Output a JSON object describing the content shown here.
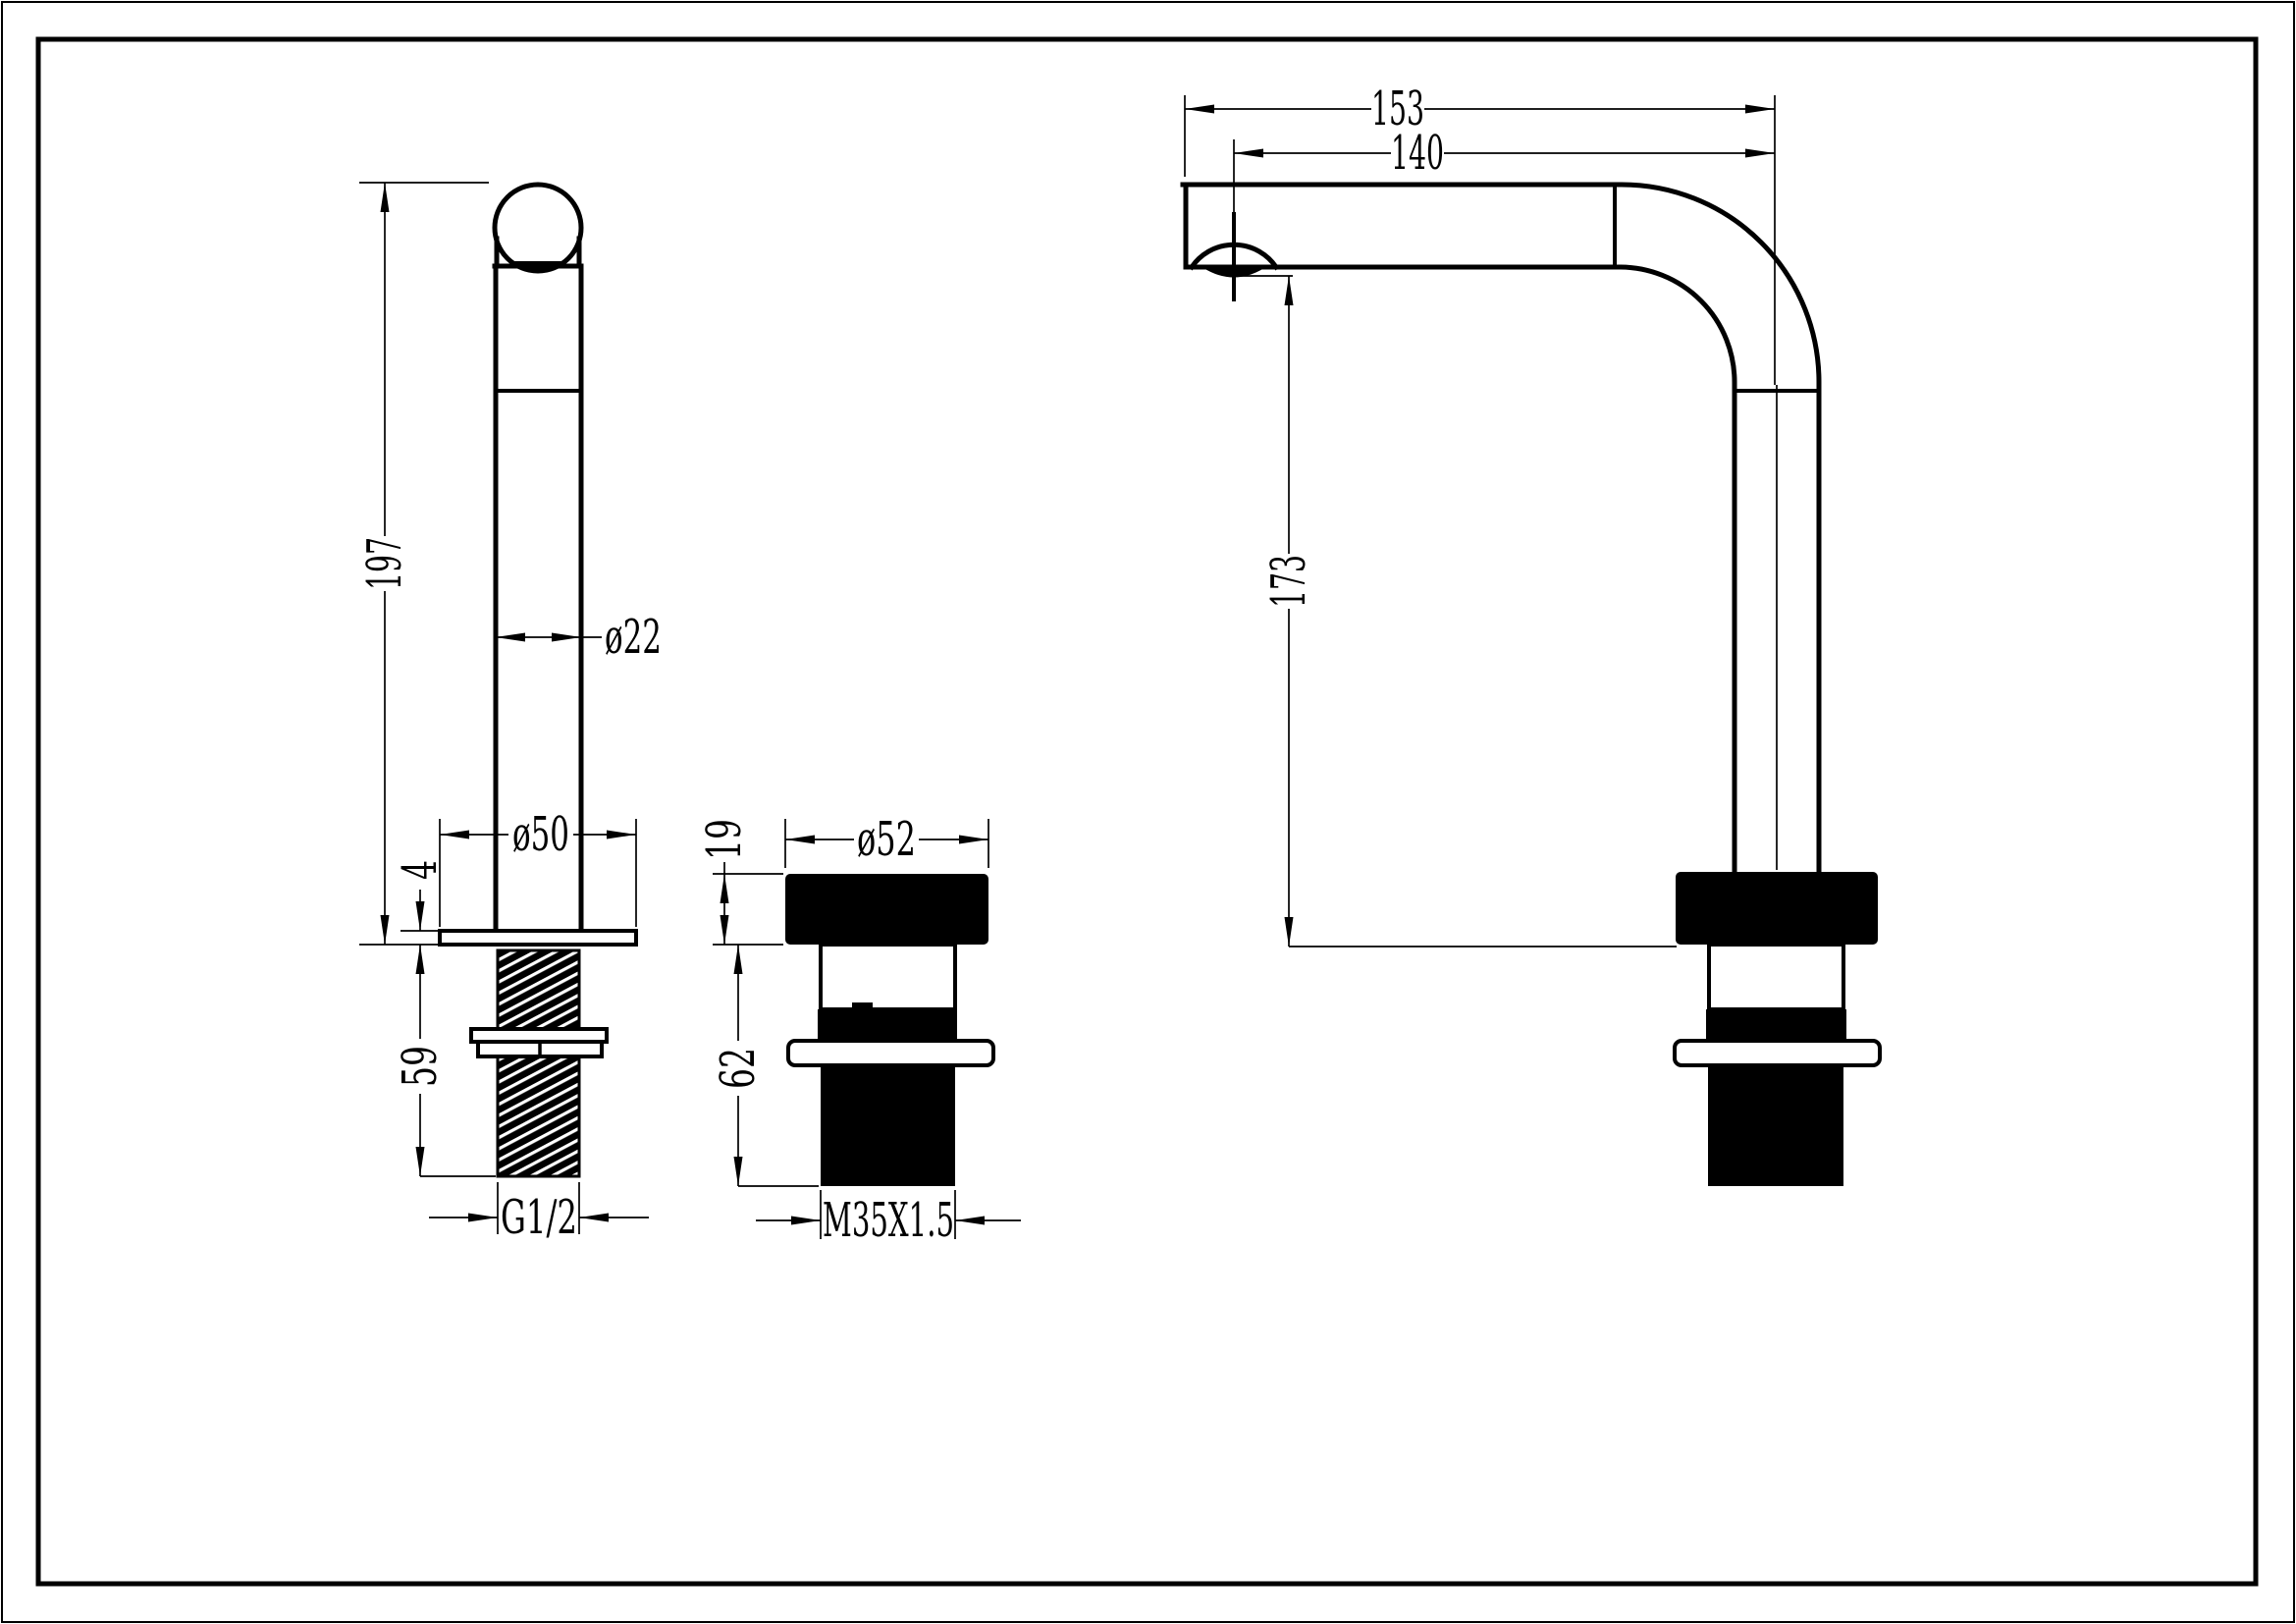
{
  "drawing": {
    "background_color": "#ffffff",
    "line_color": "#000000",
    "dims": {
      "handle": {
        "height": "197",
        "stem_diameter": "ø22",
        "flange_diameter": "ø50",
        "flange_thickness": "4",
        "shank_length": "59",
        "thread": "G1/2"
      },
      "base": {
        "cap_height": "19",
        "cap_diameter": "ø52",
        "body_height": "62",
        "thread": "M35X1.5"
      },
      "spout": {
        "reach_total": "153",
        "reach_to_outlet": "140",
        "outlet_height": "173"
      }
    }
  }
}
